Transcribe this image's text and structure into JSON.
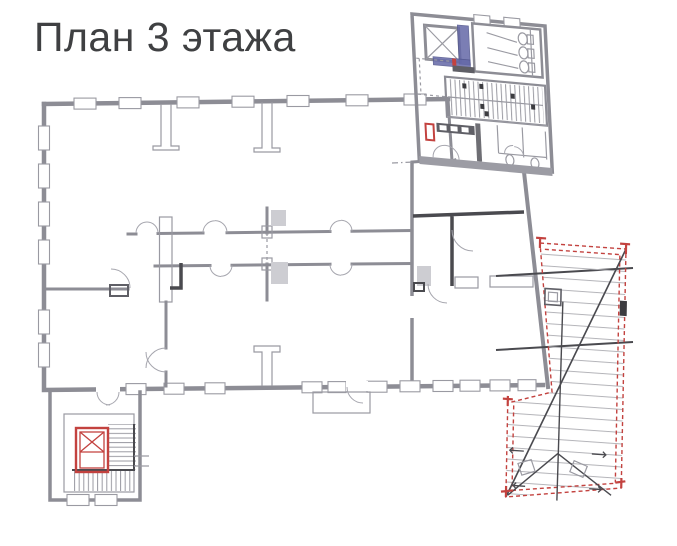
{
  "title": {
    "text": "План 3 этажа"
  },
  "colors": {
    "bg": "#ffffff",
    "title": "#3f4042",
    "wall": "#8d8d95",
    "wall-dark": "#5f5f66",
    "thin": "#9a9aa2",
    "dark": "#4a4a4f",
    "accent-red": "#c3423f",
    "accent-red-fill": "#f6d2cf",
    "accent-blue": "#6468a8",
    "gray-bar": "#9c9ca4",
    "shadow": "#cdcdd2",
    "rafter": "#b3b3b8"
  },
  "plan": {
    "features": [
      "main-building-block",
      "window-openings",
      "interior-partitions-with-door-swings",
      "upper-wing-with-wc-and-staircase",
      "crossed-shaft",
      "blue-highlighted-walls",
      "red-highlighted-elevator",
      "stairwell-annex",
      "balcony",
      "roof-overlay-red-dashed"
    ]
  }
}
